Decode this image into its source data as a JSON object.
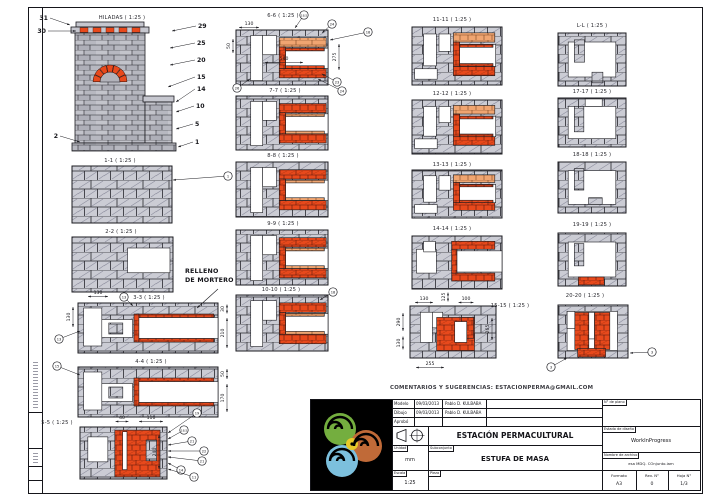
{
  "comments_line": "COMENTARIOS Y SUGERENCIAS: ESTACIONPERMA@GMAIL.COM",
  "note": {
    "line1": "RELLENO",
    "line2": "DE MORTERO"
  },
  "colors": {
    "line": "#1b1b20",
    "brick_gray": "#cbccd4",
    "brick_elevation": "#b7b8c0",
    "refractory_red": "#e8491c",
    "mortar_tan": "#f0a571",
    "niche_gray": "#b2b3bb",
    "logo_green": "#74ae3f",
    "logo_orange": "#c06a38",
    "logo_blue": "#7cc0dd",
    "logo_yellow": "#e9c928"
  },
  "titleblock": {
    "rows": [
      {
        "label": "Modelo",
        "date": "09/03/2013",
        "name": "Pablo D. KULBABA"
      },
      {
        "label": "Dibujo",
        "date": "09/03/2013",
        "name": "Pablo D. KULBABA"
      },
      {
        "label": "Aprobó",
        "date": "",
        "name": ""
      }
    ],
    "org": "ESTACIÓN PERMACULTURAL",
    "project": "ESTUFA DE MASA",
    "unit_label": "Unidad",
    "unit": "mm",
    "scale_label": "Escala",
    "scale": "1:25",
    "subassembly_label": "Subconjunto",
    "part_label": "Pieza",
    "plano_label": "N° de plano",
    "estado_label": "Estado de diseño",
    "estado": "WorkInProgress",
    "archivo_label": "Nombre de archivo",
    "archivo": "esa MDQ. COnjunto.iam",
    "formato_label": "Formato",
    "formato": "A3",
    "rev_label": "Rev. N°",
    "rev": "0",
    "hoja_label": "Hoja N°",
    "hoja": "1/3"
  },
  "presets": {
    "cp1": [
      [
        "w",
        0.04,
        0.1,
        0.13,
        0.76
      ],
      [
        "w",
        0.17,
        0.33,
        0.22,
        0.36
      ],
      [
        "g",
        0.22,
        0.4,
        0.1,
        0.22
      ],
      [
        "w",
        0.4,
        0.29,
        0.6,
        0.42
      ],
      [
        "r",
        0.42,
        0.22,
        0.55,
        0.07
      ],
      [
        "r",
        0.42,
        0.71,
        0.55,
        0.07
      ],
      [
        "r",
        0.4,
        0.22,
        0.035,
        0.56
      ]
    ],
    "fire": [
      [
        "w",
        0.09,
        0.19,
        0.23,
        0.48
      ],
      [
        "r",
        0.4,
        0.06,
        0.52,
        0.9
      ],
      [
        "g",
        0.76,
        0.25,
        0.12,
        0.4
      ],
      [
        "w",
        0.49,
        0.09,
        0.05,
        0.73
      ]
    ],
    "c2a": [
      [
        "w",
        0.16,
        0.1,
        0.13,
        0.82
      ],
      [
        "w",
        0.29,
        0.1,
        0.15,
        0.35
      ],
      [
        "t",
        0.47,
        0.14,
        0.51,
        0.17
      ],
      [
        "r",
        0.47,
        0.7,
        0.51,
        0.17
      ],
      [
        "r",
        0.47,
        0.31,
        0.07,
        0.39
      ],
      [
        "w",
        0.54,
        0.33,
        0.46,
        0.37
      ],
      [
        "r",
        0.54,
        0.33,
        0.42,
        0.05
      ],
      [
        "r",
        0.54,
        0.65,
        0.42,
        0.05
      ]
    ],
    "c2": [
      [
        "w",
        0.16,
        0.1,
        0.13,
        0.82
      ],
      [
        "w",
        0.29,
        0.1,
        0.15,
        0.35
      ],
      [
        "r",
        0.47,
        0.14,
        0.51,
        0.17
      ],
      [
        "r",
        0.47,
        0.7,
        0.51,
        0.17
      ],
      [
        "r",
        0.47,
        0.31,
        0.07,
        0.39
      ],
      [
        "w",
        0.54,
        0.33,
        0.46,
        0.37
      ],
      [
        "t",
        0.54,
        0.33,
        0.42,
        0.05
      ],
      [
        "t",
        0.54,
        0.65,
        0.42,
        0.05
      ]
    ],
    "c3": [
      [
        "w",
        0.13,
        0.12,
        0.14,
        0.55
      ],
      [
        "w",
        0.3,
        0.12,
        0.13,
        0.3
      ],
      [
        "w",
        0.03,
        0.72,
        0.25,
        0.18
      ],
      [
        "t",
        0.46,
        0.1,
        0.46,
        0.16
      ],
      [
        "r",
        0.46,
        0.68,
        0.46,
        0.16
      ],
      [
        "r",
        0.46,
        0.26,
        0.07,
        0.42
      ],
      [
        "w",
        0.53,
        0.3,
        0.4,
        0.38
      ],
      [
        "r",
        0.53,
        0.3,
        0.37,
        0.05
      ],
      [
        "r",
        0.53,
        0.63,
        0.37,
        0.05
      ]
    ],
    "c14": [
      [
        "w",
        0.05,
        0.25,
        0.22,
        0.45
      ],
      [
        "w",
        0.13,
        0.1,
        0.13,
        0.2
      ],
      [
        "r",
        0.44,
        0.1,
        0.48,
        0.15
      ],
      [
        "r",
        0.44,
        0.7,
        0.48,
        0.15
      ],
      [
        "r",
        0.44,
        0.25,
        0.06,
        0.45
      ],
      [
        "w",
        0.5,
        0.28,
        0.5,
        0.4
      ]
    ],
    "c15": [
      [
        "w",
        0.12,
        0.12,
        0.14,
        0.58
      ],
      [
        "w",
        0.26,
        0.12,
        0.12,
        0.3
      ],
      [
        "r",
        0.31,
        0.22,
        0.44,
        0.64
      ],
      [
        "r",
        0.6,
        0.22,
        0.14,
        0.4
      ],
      [
        "w",
        0.52,
        0.3,
        0.14,
        0.4
      ]
    ],
    "sq1": [
      [
        "w",
        0.15,
        0.17,
        0.7,
        0.66
      ],
      [
        "g",
        0.24,
        0.13,
        0.15,
        0.42
      ],
      [
        "g",
        0.5,
        0.74,
        0.16,
        0.2
      ]
    ],
    "sq2": [
      [
        "w",
        0.15,
        0.17,
        0.7,
        0.66
      ],
      [
        "g",
        0.24,
        0.17,
        0.14,
        0.52
      ],
      [
        "w",
        0.4,
        0.02,
        0.25,
        0.15
      ]
    ],
    "sq3": [
      [
        "w",
        0.15,
        0.17,
        0.7,
        0.66
      ],
      [
        "g",
        0.24,
        0.13,
        0.14,
        0.42
      ],
      [
        "g",
        0.45,
        0.7,
        0.2,
        0.13
      ]
    ],
    "sq4": [
      [
        "w",
        0.15,
        0.17,
        0.7,
        0.66
      ],
      [
        "g",
        0.24,
        0.2,
        0.14,
        0.42
      ],
      [
        "r",
        0.3,
        0.83,
        0.38,
        0.15
      ]
    ],
    "sq5": [
      [
        "w",
        0.13,
        0.12,
        0.72,
        0.74
      ],
      [
        "r",
        0.24,
        0.14,
        0.2,
        0.7
      ],
      [
        "r",
        0.52,
        0.14,
        0.22,
        0.7
      ],
      [
        "w",
        0.44,
        0.14,
        0.08,
        0.5
      ],
      [
        "r",
        0.28,
        0.82,
        0.4,
        0.16
      ],
      [
        "w",
        0.13,
        0.12,
        0.11,
        0.32
      ]
    ]
  },
  "views": [
    {
      "id": "hiladas",
      "label": "HILADAS ( 1:25 )",
      "lx": 122,
      "ly": 19,
      "x": 72,
      "y": 22,
      "w": 102,
      "h": 130,
      "type": "elevation",
      "plain": true,
      "callouts": [
        [
          "31",
          48,
          20,
          70,
          25
        ],
        [
          "30",
          46,
          33,
          76,
          31
        ],
        [
          "2",
          58,
          138,
          80,
          142
        ],
        [
          "29",
          198,
          28,
          172,
          31
        ],
        [
          "25",
          197,
          45,
          170,
          48
        ],
        [
          "20",
          197,
          62,
          170,
          65
        ],
        [
          "15",
          197,
          79,
          168,
          87
        ],
        [
          "14",
          197,
          91,
          176,
          102
        ],
        [
          "10",
          196,
          108,
          176,
          112
        ],
        [
          "5",
          195,
          126,
          176,
          129
        ],
        [
          "1",
          195,
          144,
          178,
          147
        ]
      ]
    },
    {
      "id": "1-1",
      "label": "1-1 ( 1:25 )",
      "lx": 120,
      "ly": 162,
      "x": 72,
      "y": 166,
      "w": 100,
      "h": 57,
      "callouts": [
        [
          "1",
          228,
          176,
          173,
          180
        ]
      ]
    },
    {
      "id": "2-2",
      "label": "2-2 ( 1:25 )",
      "lx": 121,
      "ly": 233,
      "x": 72,
      "y": 237,
      "w": 101,
      "h": 55,
      "overlays": [
        [
          "w",
          0.55,
          0.2,
          0.42,
          0.45
        ]
      ]
    },
    {
      "id": "3-3",
      "label": "3-3 ( 1:25 )",
      "lx": 149,
      "ly": 299,
      "x": 78,
      "y": 303,
      "w": 140,
      "h": 50,
      "ov": "cp1",
      "dims": [
        [
          "130",
          98,
          294,
          0,
          20
        ],
        [
          "130",
          70,
          317,
          90,
          20
        ],
        [
          "30",
          224,
          309,
          90,
          9
        ],
        [
          "210",
          224,
          333,
          90,
          30
        ]
      ],
      "callouts": [
        [
          "13",
          124,
          297,
          133,
          306
        ],
        [
          "13",
          59,
          339,
          80,
          331
        ]
      ]
    },
    {
      "id": "4-4",
      "label": "4-4 ( 1:25 )",
      "lx": 151,
      "ly": 363,
      "x": 78,
      "y": 367,
      "w": 140,
      "h": 50,
      "ov": "cp1",
      "dims": [
        [
          "50",
          224,
          374,
          90,
          10
        ],
        [
          "170",
          224,
          398,
          90,
          28
        ]
      ],
      "callouts": [
        [
          "15",
          57,
          366,
          80,
          375
        ]
      ]
    },
    {
      "id": "5-5",
      "label": "5-5 ( 1:25 )",
      "lx": 57,
      "ly": 424,
      "x": 80,
      "y": 427,
      "w": 87,
      "h": 52,
      "ov": "fire",
      "dims": [
        [
          "40",
          122,
          419,
          0,
          13
        ],
        [
          "110",
          151,
          419,
          0,
          24
        ],
        [
          "240",
          156,
          452,
          90,
          34
        ]
      ],
      "callouts": [
        [
          "19",
          197,
          413,
          168,
          433
        ],
        [
          "18,5",
          184,
          430,
          168,
          439
        ],
        [
          "21",
          192,
          441,
          168,
          445
        ],
        [
          "22",
          204,
          451,
          168,
          451
        ],
        [
          "21",
          202,
          461,
          168,
          457
        ],
        [
          "14",
          181,
          470,
          168,
          463
        ],
        [
          "11",
          194,
          477,
          168,
          469
        ]
      ]
    },
    {
      "id": "6-6",
      "label": "6-6 ( 1:25 )",
      "lx": 283,
      "ly": 17,
      "x": 236,
      "y": 30,
      "w": 92,
      "h": 55,
      "ov": "c2a",
      "dims": [
        [
          "130",
          249,
          25,
          0,
          20
        ],
        [
          "50",
          230,
          46,
          90,
          14
        ],
        [
          "540",
          284,
          60,
          0,
          38
        ],
        [
          "275",
          336,
          57,
          90,
          26
        ]
      ],
      "callouts": [
        [
          "18,5",
          304,
          15,
          295,
          28
        ],
        [
          "24",
          332,
          24,
          322,
          33
        ],
        [
          "18",
          368,
          32,
          330,
          40
        ],
        [
          "23",
          337,
          82,
          322,
          74
        ],
        [
          "24",
          342,
          91,
          318,
          79
        ],
        [
          "26",
          237,
          88,
          250,
          79
        ]
      ]
    },
    {
      "id": "7-7",
      "label": "7-7 ( 1:25 )",
      "lx": 285,
      "ly": 92,
      "x": 236,
      "y": 96,
      "w": 92,
      "h": 54,
      "ov": "c2"
    },
    {
      "id": "8-8",
      "label": "8-8 ( 1:25 )",
      "lx": 283,
      "ly": 157,
      "x": 236,
      "y": 162,
      "w": 92,
      "h": 55,
      "ov": "c2"
    },
    {
      "id": "9-9",
      "label": "9-9 ( 1:25 )",
      "lx": 283,
      "ly": 225,
      "x": 236,
      "y": 230,
      "w": 92,
      "h": 55,
      "ov": "c2"
    },
    {
      "id": "10-10",
      "label": "10-10 ( 1:25 )",
      "lx": 281,
      "ly": 291,
      "x": 236,
      "y": 295,
      "w": 92,
      "h": 56,
      "ov": "c2",
      "callouts": [
        [
          "18",
          333,
          292,
          320,
          300
        ]
      ]
    },
    {
      "id": "11-11",
      "label": "11-11 ( 1:25 )",
      "lx": 452,
      "ly": 21,
      "x": 412,
      "y": 27,
      "w": 90,
      "h": 58,
      "ov": "c3"
    },
    {
      "id": "12-12",
      "label": "12-12 ( 1:25 )",
      "lx": 452,
      "ly": 95,
      "x": 412,
      "y": 100,
      "w": 90,
      "h": 54,
      "ov": "c3"
    },
    {
      "id": "13-13",
      "label": "13-13 ( 1:25 )",
      "lx": 452,
      "ly": 166,
      "x": 412,
      "y": 170,
      "w": 90,
      "h": 48,
      "ov": "c3"
    },
    {
      "id": "14-14",
      "label": "14-14 ( 1:25 )",
      "lx": 452,
      "ly": 230,
      "x": 412,
      "y": 236,
      "w": 90,
      "h": 53,
      "ov": "c14"
    },
    {
      "id": "15-15",
      "label": "15-15 ( 1:25 )",
      "lx": 510,
      "ly": 307,
      "x": 410,
      "y": 306,
      "w": 86,
      "h": 52,
      "ov": "c15",
      "dims": [
        [
          "130",
          424,
          300,
          0,
          18
        ],
        [
          "125",
          445,
          297,
          90,
          9
        ],
        [
          "100",
          466,
          300,
          0,
          15
        ],
        [
          "290",
          400,
          322,
          90,
          18
        ],
        [
          "130",
          400,
          343,
          90,
          13
        ],
        [
          "265",
          489,
          329,
          90,
          22
        ],
        [
          "255",
          430,
          365,
          0,
          28
        ]
      ]
    },
    {
      "id": "L-L",
      "label": "L-L ( 1:25 )",
      "lx": 592,
      "ly": 27,
      "x": 558,
      "y": 33,
      "w": 68,
      "h": 53,
      "ov": "sq1"
    },
    {
      "id": "17-17",
      "label": "17-17 ( 1:25 )",
      "lx": 592,
      "ly": 93,
      "x": 558,
      "y": 98,
      "w": 68,
      "h": 49,
      "ov": "sq2"
    },
    {
      "id": "18-18",
      "label": "18-18 ( 1:25 )",
      "lx": 592,
      "ly": 156,
      "x": 558,
      "y": 162,
      "w": 68,
      "h": 51,
      "ov": "sq3"
    },
    {
      "id": "19-19",
      "label": "19-19 ( 1:25 )",
      "lx": 592,
      "ly": 226,
      "x": 558,
      "y": 233,
      "w": 68,
      "h": 53,
      "ov": "sq4"
    },
    {
      "id": "20-20",
      "label": "20-20 ( 1:25 )",
      "lx": 585,
      "ly": 297,
      "x": 558,
      "y": 305,
      "w": 70,
      "h": 53,
      "ov": "sq5",
      "callouts": [
        [
          "3",
          551,
          367,
          567,
          358
        ],
        [
          "3",
          652,
          352,
          630,
          353
        ]
      ]
    }
  ],
  "note_leader": [
    218,
    289,
    197,
    308
  ]
}
